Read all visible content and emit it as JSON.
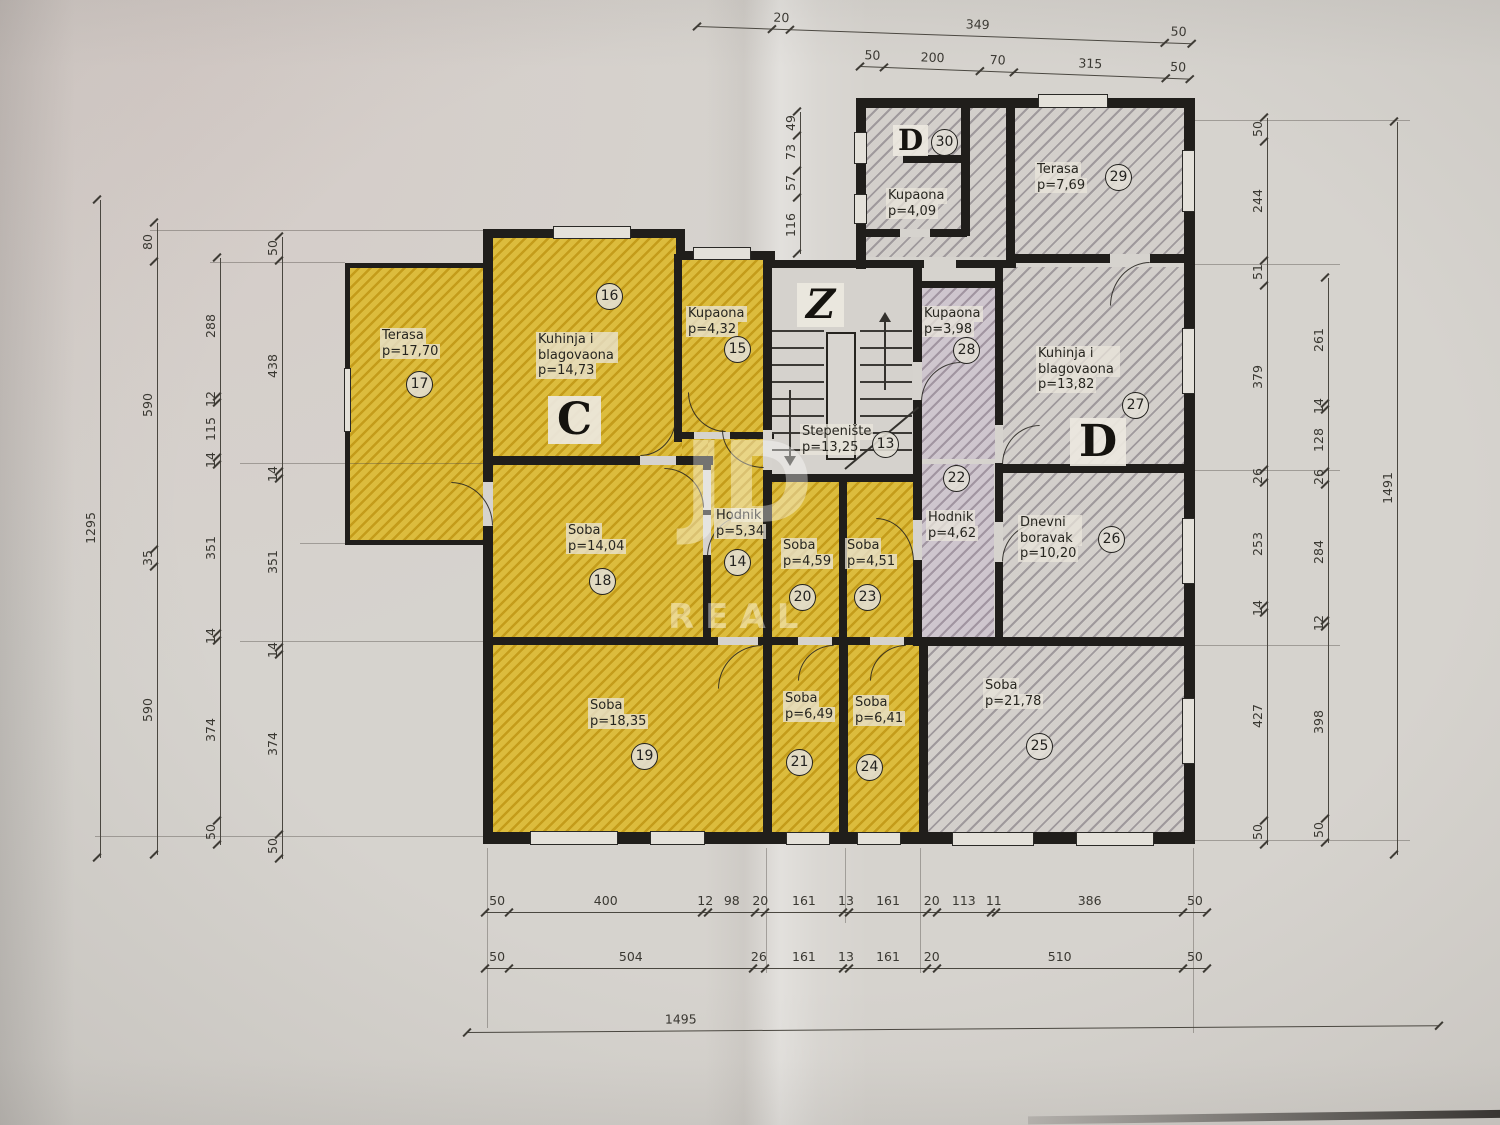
{
  "letters": {
    "c": "C",
    "d": "D",
    "z": "Z",
    "d_top": "D"
  },
  "watermark": {
    "line1": "JD",
    "line2": "REAL"
  },
  "rooms": {
    "r13": {
      "name": "Stepenište",
      "area": "p=13,25",
      "num": "13"
    },
    "r14": {
      "name": "Hodnik",
      "area": "p=5,34",
      "num": "14"
    },
    "r15": {
      "name": "Kupaona",
      "area": "p=4,32",
      "num": "15"
    },
    "r16": {
      "name": "Kuhinja i blagovaona",
      "area": "p=14,73",
      "num": "16"
    },
    "r17": {
      "name": "Terasa",
      "area": "p=17,70",
      "num": "17"
    },
    "r18": {
      "name": "Soba",
      "area": "p=14,04",
      "num": "18"
    },
    "r19": {
      "name": "Soba",
      "area": "p=18,35",
      "num": "19"
    },
    "r20": {
      "name": "Soba",
      "area": "p=4,59",
      "num": "20"
    },
    "r21": {
      "name": "Soba",
      "area": "p=6,49",
      "num": "21"
    },
    "r22": {
      "name": "Hodnik",
      "area": "p=4,62",
      "num": "22"
    },
    "r23": {
      "name": "Soba",
      "area": "p=4,51",
      "num": "23"
    },
    "r24": {
      "name": "Soba",
      "area": "p=6,41",
      "num": "24"
    },
    "r25": {
      "name": "Soba",
      "area": "p=21,78",
      "num": "25"
    },
    "r26": {
      "name": "Dnevni boravak",
      "area": "p=10,20",
      "num": "26"
    },
    "r27": {
      "name": "Kuhinja i blagovaona",
      "area": "p=13,82",
      "num": "27"
    },
    "r28": {
      "name": "Kupaona",
      "area": "p=3,98",
      "num": "28"
    },
    "r29": {
      "name": "Terasa",
      "area": "p=7,69",
      "num": "29"
    },
    "r30": {
      "name": "Kupaona",
      "area": "p=4,09",
      "num": "30"
    }
  },
  "dimensions": {
    "top_partial": {
      "values": [
        "",
        "20",
        "349",
        "50"
      ]
    },
    "top": {
      "values": [
        50,
        200,
        70,
        315,
        50
      ]
    },
    "left_overall": {
      "values": [
        1295
      ]
    },
    "left_col2": {
      "values": [
        80,
        590,
        35,
        590
      ]
    },
    "left_col3": {
      "values": [
        288,
        12,
        115,
        14,
        351,
        14,
        374,
        50
      ]
    },
    "left_col4": {
      "values": [
        50,
        438,
        14,
        351,
        14,
        374,
        50
      ]
    },
    "right_colA": {
      "values": [
        50,
        244,
        51,
        379,
        26,
        253,
        14,
        427,
        50
      ]
    },
    "right_colB": {
      "values": [
        261,
        14,
        128,
        26,
        284,
        12,
        398,
        50
      ]
    },
    "right_overall": {
      "values": [
        1491
      ]
    },
    "mid_chain": {
      "values": [
        49,
        73,
        57,
        116
      ]
    },
    "bottom_row1": {
      "values": [
        50,
        400,
        12,
        98,
        20,
        161,
        13,
        161,
        20,
        113,
        11,
        386,
        50
      ]
    },
    "bottom_row2": {
      "values": [
        50,
        504,
        26,
        161,
        13,
        161,
        20,
        510,
        50
      ]
    },
    "bottom_overall": {
      "values": [
        1495
      ]
    }
  }
}
